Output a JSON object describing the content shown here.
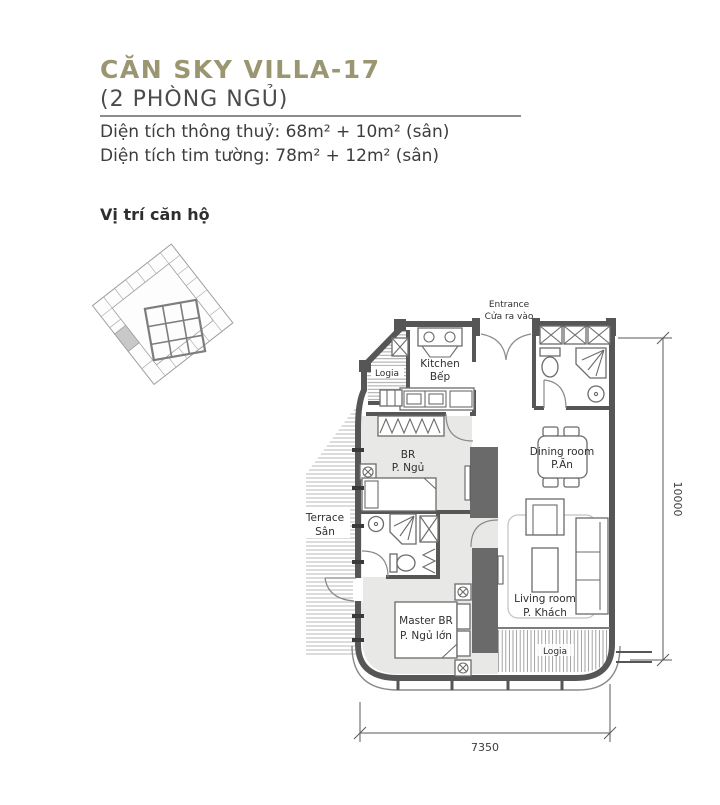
{
  "colors": {
    "accent_olive": "#9a9671",
    "wall_gray": "#565656",
    "room_fill": "#e8e8e6",
    "column_fill": "#6a6a6a",
    "highlight_unit": "#c9c9c9"
  },
  "header": {
    "title": "CĂN SKY VILLA-17",
    "subtitle": "(2 PHÒNG NGỦ)",
    "area_line1": "Diện tích thông thuỷ: 68m² + 10m² (sân)",
    "area_line2": "Diện tích tim tường: 78m² + 12m² (sân)"
  },
  "location_section": {
    "label": "Vị trí căn hộ"
  },
  "plan": {
    "entrance": {
      "en": "Entrance",
      "vi": "Cửa ra vào"
    },
    "rooms": {
      "kitchen": {
        "en": "Kitchen",
        "vi": "Bếp"
      },
      "logia_top": {
        "label": "Logia"
      },
      "bedroom": {
        "en": "BR",
        "vi": "P. Ngủ"
      },
      "dining": {
        "en": "Dining room",
        "vi": "P.Ăn"
      },
      "terrace": {
        "en": "Terrace",
        "vi": "Sân"
      },
      "master_bedroom": {
        "en": "Master BR",
        "vi": "P. Ngủ lớn"
      },
      "living": {
        "en": "Living room",
        "vi": "P. Khách"
      },
      "logia_bottom": {
        "label": "Logia"
      }
    },
    "dimensions": {
      "width_mm": "7350",
      "height_mm": "10000"
    }
  }
}
